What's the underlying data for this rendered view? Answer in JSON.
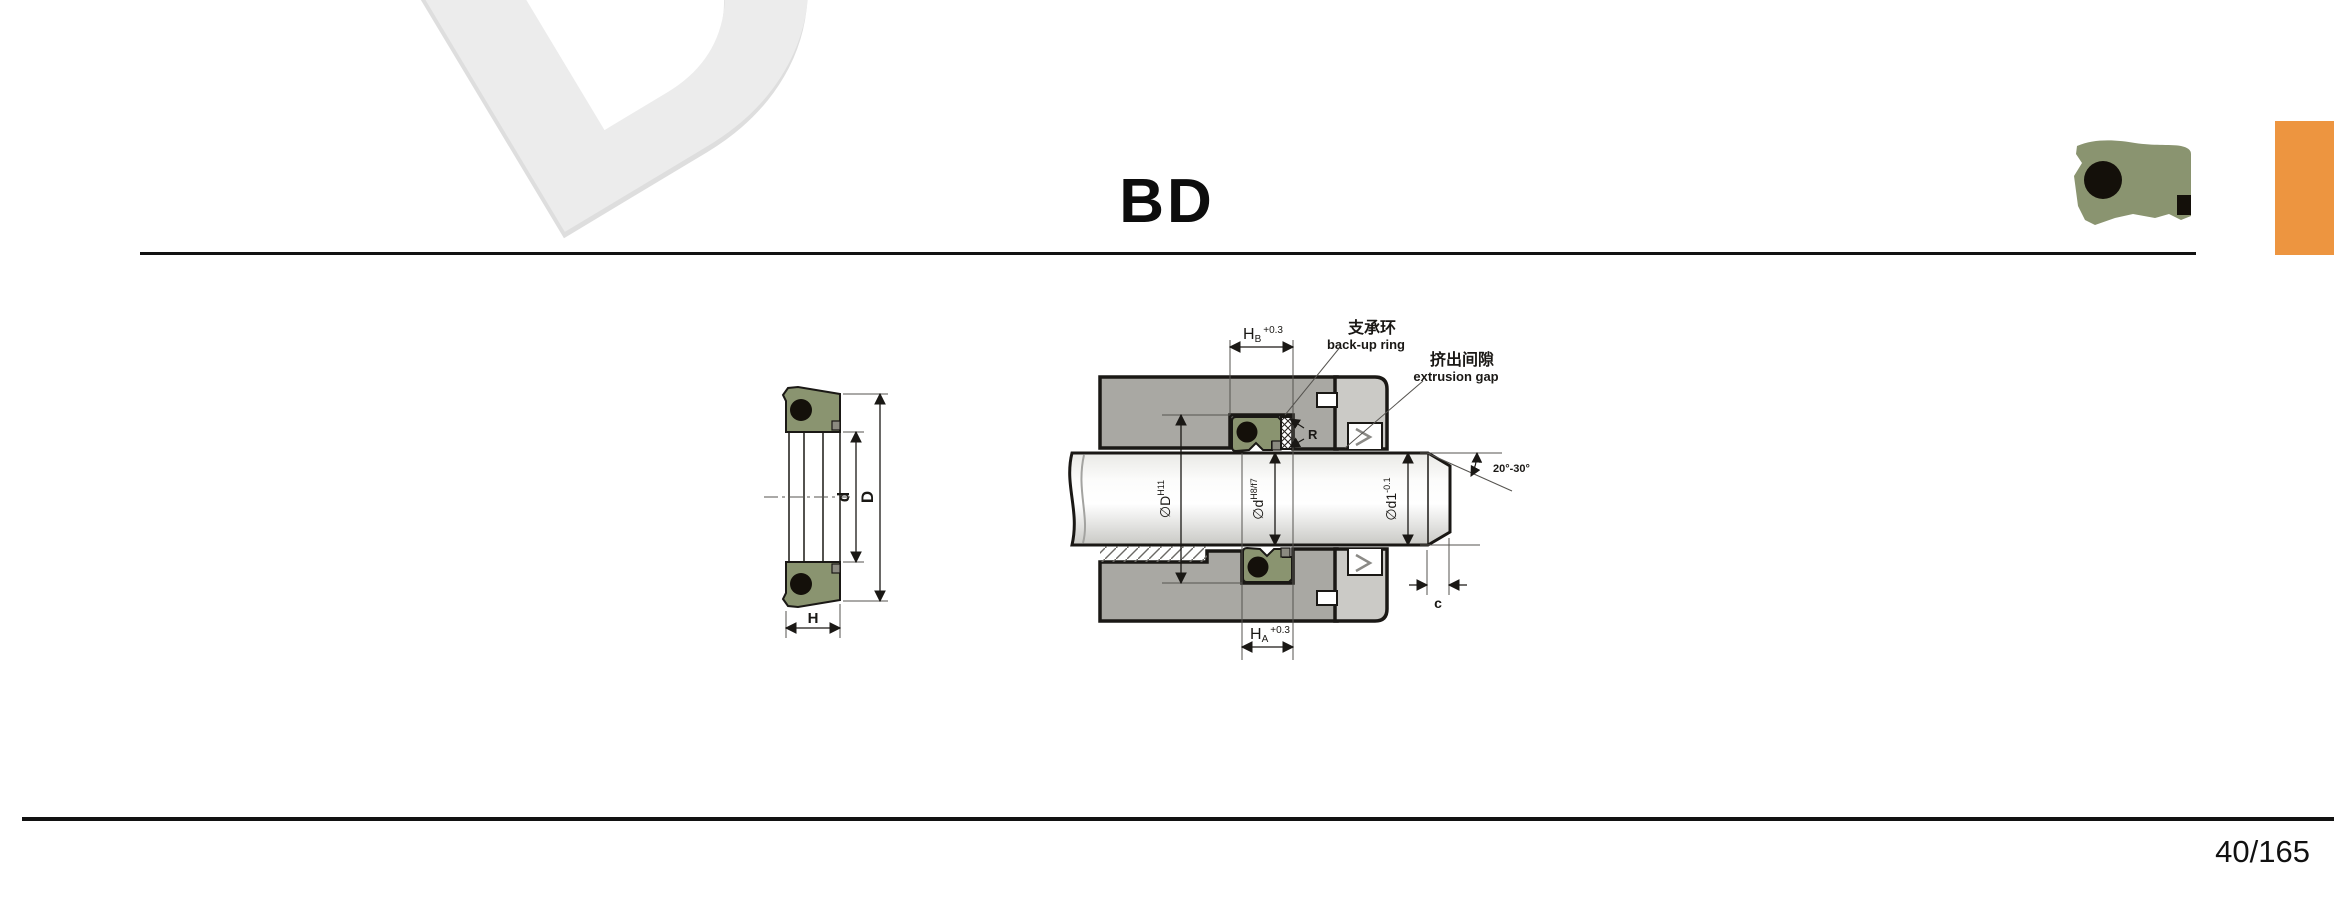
{
  "page": {
    "title": "BD",
    "page_number": "40/165",
    "watermark": "DS"
  },
  "colors": {
    "seal_green": "#8A9470",
    "oring_black": "#14100A",
    "housing_gray": "#A9A8A3",
    "gland_gray": "#CBCAC6",
    "accent_orange": "#ED9540",
    "watermark_gray": "#ECECEC",
    "line_black": "#1A1815"
  },
  "left_view": {
    "dim_d": "d",
    "dim_D": "D",
    "dim_H": "H"
  },
  "section_view": {
    "dim_hb_main": "H",
    "dim_hb_sub": "B",
    "dim_hb_tol": "+0.3",
    "dim_ha_main": "H",
    "dim_ha_sub": "A",
    "dim_ha_tol": "+0.3",
    "backup_ring_cn": "支承环",
    "backup_ring_en": "back-up ring",
    "extrusion_gap_cn": "挤出间隙",
    "extrusion_gap_en": "extrusion gap",
    "radius_label": "R",
    "dim_D_main": "∅D",
    "dim_D_tol": "H11",
    "dim_d_main": "∅d",
    "dim_d_tol": "H8/f7",
    "dim_d1_main": "∅d1",
    "dim_d1_tol": "-0.1",
    "chamfer_angle": "20°-30°",
    "clearance_label": "c"
  }
}
